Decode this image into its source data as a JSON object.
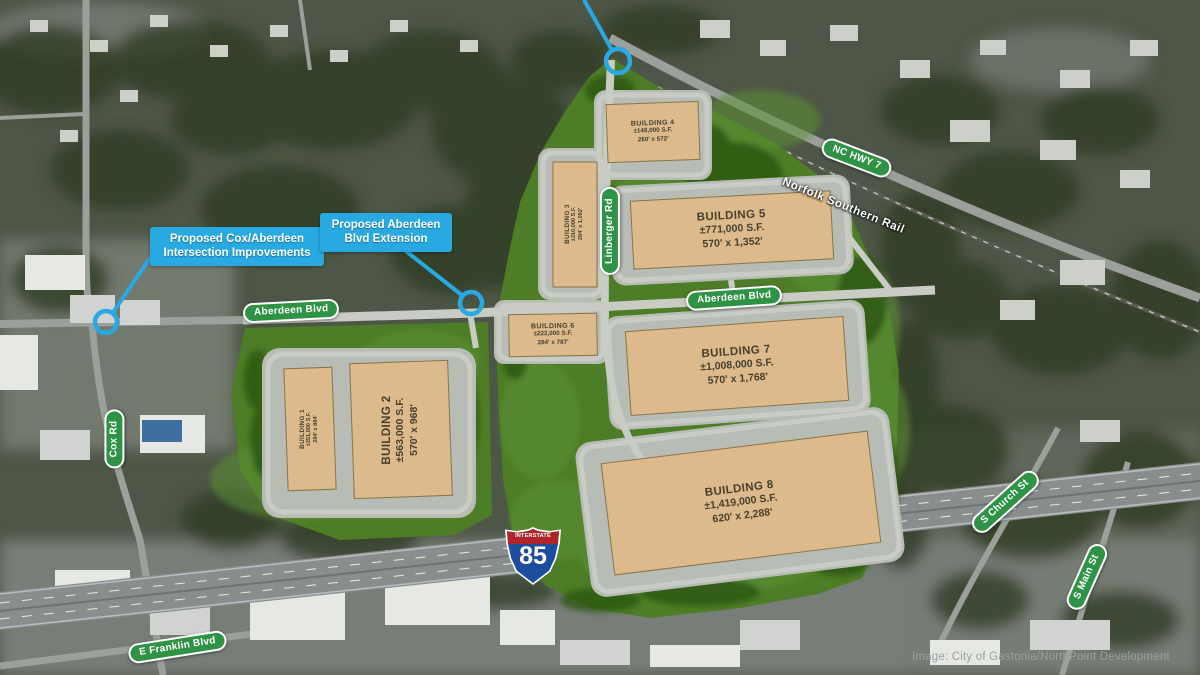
{
  "buildings": {
    "b1": {
      "name": "BUILDING 1",
      "area": "±251,000 S.F.",
      "dims": "284' x 884'"
    },
    "b2": {
      "name": "BUILDING 2",
      "area": "±563,000 S.F.",
      "dims": "570' x 968'"
    },
    "b3": {
      "name": "BUILDING 3",
      "area": "±310,000 S.F.",
      "dims": "284' x 1,092'"
    },
    "b4": {
      "name": "BUILDING 4",
      "area": "±148,000 S.F.",
      "dims": "260' x 572'"
    },
    "b5": {
      "name": "BUILDING 5",
      "area": "±771,000 S.F.",
      "dims": "570' x 1,352'"
    },
    "b6": {
      "name": "BUILDING 6",
      "area": "±222,000 S.F.",
      "dims": "284' x 787'"
    },
    "b7": {
      "name": "BUILDING 7",
      "area": "±1,008,000 S.F.",
      "dims": "570' x 1,768'"
    },
    "b8": {
      "name": "BUILDING 8",
      "area": "±1,419,000 S.F.",
      "dims": "620' x 2,288'"
    }
  },
  "callouts": {
    "cox_aberdeen": "Proposed Cox/Aberdeen\nIntersection Improvements",
    "aberdeen_ext": "Proposed Aberdeen\nBlvd Extension"
  },
  "signs": {
    "aberdeen_w": "Aberdeen Blvd",
    "aberdeen_e": "Aberdeen Blvd",
    "linberger": "Linberger Rd",
    "cox": "Cox Rd",
    "franklin": "E Franklin Blvd",
    "nc_hwy7": "NC HWY 7",
    "church": "S Church St",
    "main": "S Main St"
  },
  "rail_label": "Norfolk Southern Rail",
  "interstate": {
    "top": "INTERSTATE",
    "number": "85"
  },
  "caption": "Image: City of Gastonia/NorthPoint Development",
  "colors": {
    "callout_blue": "#29a9e1",
    "sign_green": "#2f9345",
    "building_tan": "#dcba8b",
    "site_green": "#4d7d26",
    "shield_blue": "#1d4e9e",
    "shield_red": "#b0252a"
  }
}
